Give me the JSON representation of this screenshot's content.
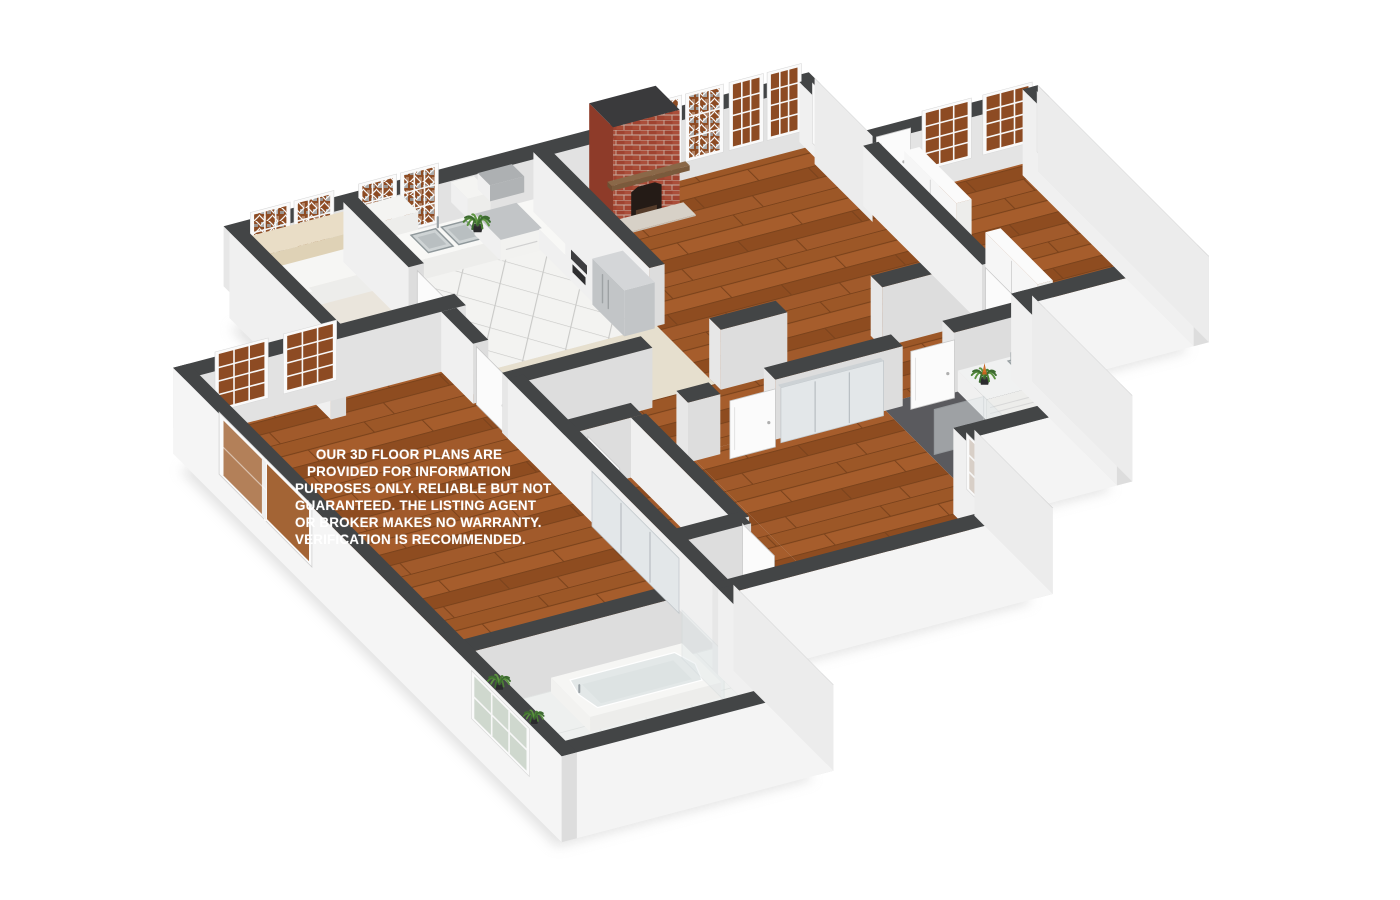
{
  "page": {
    "title": "3D Floor Plan Render",
    "background": "#ffffff"
  },
  "disclaimer": {
    "line1": "OUR 3D FLOOR PLANS ARE",
    "line2": "PROVIDED FOR INFORMATION",
    "line3": "PURPOSES ONLY. RELIABLE BUT NOT",
    "line4": "GUARANTEED. THE LISTING AGENT",
    "line5": "OR BROKER MAKES NO WARRANTY.",
    "line6": "VERIFICATION IS RECOMMENDED."
  },
  "palette": {
    "wood": "#9C5727",
    "woodLight": "#A65D2C",
    "woodMid": "#8E4C20",
    "woodAlt": "#A15A2B",
    "woodSeam": "#7A421B",
    "cap": "#434546",
    "faceSouth": "#DDDDDD",
    "faceWest": "#F0F0F0",
    "faceEnd": "#E7E7E7",
    "faceExt": "#F4F4F4",
    "tile": "#F3F3F1",
    "grout": "#C9C9C7",
    "bathTile": "#EEF0EF",
    "bathGrout": "#DFE2E1",
    "carpet": "#E6DFCE",
    "laundryFloor": "#EAE5DC",
    "darkFloor": "#5A5A5E",
    "brick": "#A04330",
    "brickLight": "#B65A43",
    "mortar": "#C9AFA2",
    "firebox": "#241B16",
    "mantel": "#8A6848",
    "hearth": "#D7D1C7",
    "paneBrown": "#8D4B23",
    "paneLight": "#D8CFC7",
    "glassWood": "#A36435",
    "frame": "#FAFAFA",
    "mullion": "#F7F7F7",
    "stainless": "#C2C5C7",
    "stainlessDark": "#ADB0B2",
    "beige": "#E9DDC6",
    "beigeFace": "#DFD2B6",
    "white": "#FBFBFB",
    "whiteFace": "#EDEDEB",
    "basin": "#DDE2E3",
    "basinRim": "#99A1A4",
    "mirror": "#E3E7E9",
    "glass": "#E1E8EA",
    "plantDark": "#3C6B2F",
    "plantLight": "#5C9440",
    "plantMid": "#4C8035",
    "bromeliad": "#C2621F",
    "pot": "#2B2B2D",
    "shadow": "#C6C6C6"
  }
}
